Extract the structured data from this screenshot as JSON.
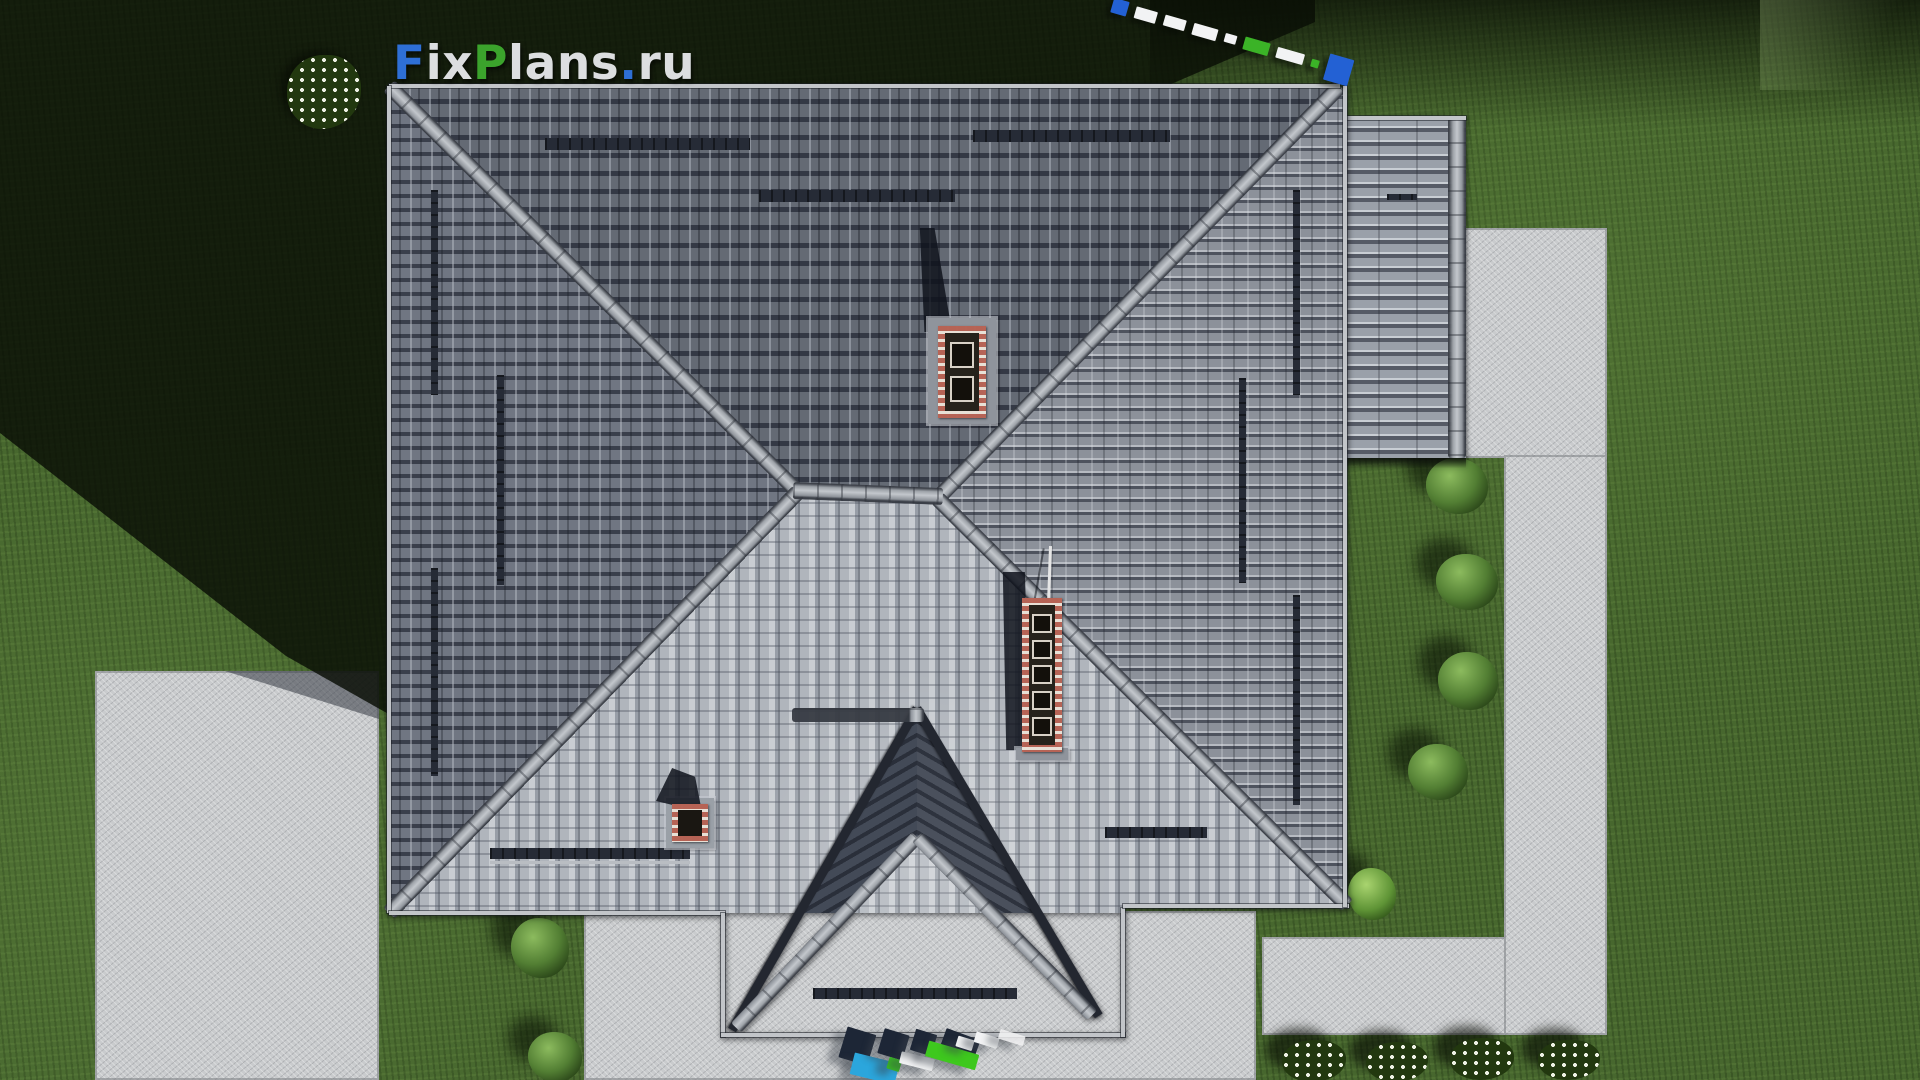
{
  "app": {
    "name": "FixPlans.ru",
    "view": "top-down 3d render of hip-roof house plan"
  },
  "logo": {
    "full_text": "FixPlans.ru",
    "parts": [
      {
        "text": "F",
        "color": "#2e6fd6"
      },
      {
        "text": "ix",
        "color": "#dcdee0"
      },
      {
        "text": "P",
        "color": "#3ba32c"
      },
      {
        "text": "lans",
        "color": "#dcdee0"
      },
      {
        "text": ".",
        "color": "#2e6fd6"
      },
      {
        "text": "ru",
        "color": "#d6d8da"
      }
    ]
  },
  "palette": {
    "lawn": "#47672e",
    "lawn_shadow": "#0e1505",
    "concrete": "#c9cbcd",
    "roof_top_slope": "#4c515c",
    "roof_left_slope": "#5c616c",
    "roof_right_slope": "#878c94",
    "roof_sun_slope": "#c3c7cc",
    "ridge_cap": "#a6abb0",
    "porch_slope": "#353a46",
    "brick_red": "#b25648",
    "brick_mortar": "#e4ddd3",
    "flue_dark": "#13100b",
    "watermark_blue": "#2361d4",
    "watermark_cyan": "#2ba6dc",
    "watermark_green": "#3bc21f",
    "watermark_white": "#f2f3f4",
    "watermark_navy": "#1d2636"
  },
  "scene": {
    "large_chimney_flues": 5,
    "top_chimney_flues": 2,
    "small_roof_chimneys": 1,
    "right_hedge_bushes": 4,
    "bottom_left_bushes": 2,
    "bottom_right_flower_clusters": 4,
    "top_left_flower_clusters": 1,
    "snow_guard_bars": 10
  }
}
